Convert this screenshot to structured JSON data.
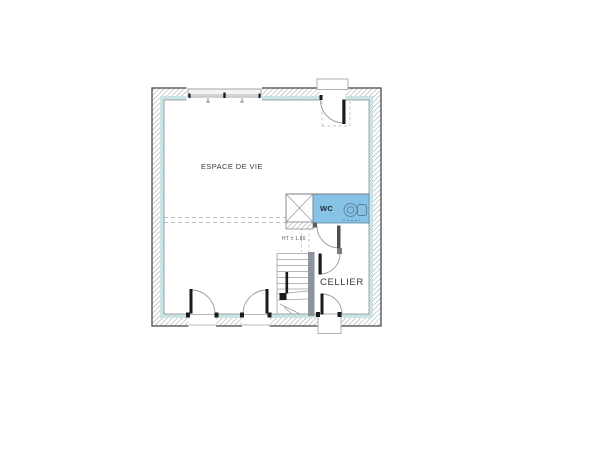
{
  "floorplan": {
    "type": "floor-plan",
    "labels": {
      "living_room": "ESPACE DE VIE",
      "wc": "WC",
      "cellar": "CELLIER",
      "stair_height_note": "HT ± 1.80"
    },
    "colors": {
      "wc_fill": "#86c3e7",
      "wall_hatch_line": "#a8adb2",
      "insulation": "#aed3d3",
      "stair_wall": "#8d939c",
      "door_leaf": "#1b1b1b",
      "swing_arc": "#9a9a9a",
      "dashed": "#c2c2c2"
    }
  }
}
